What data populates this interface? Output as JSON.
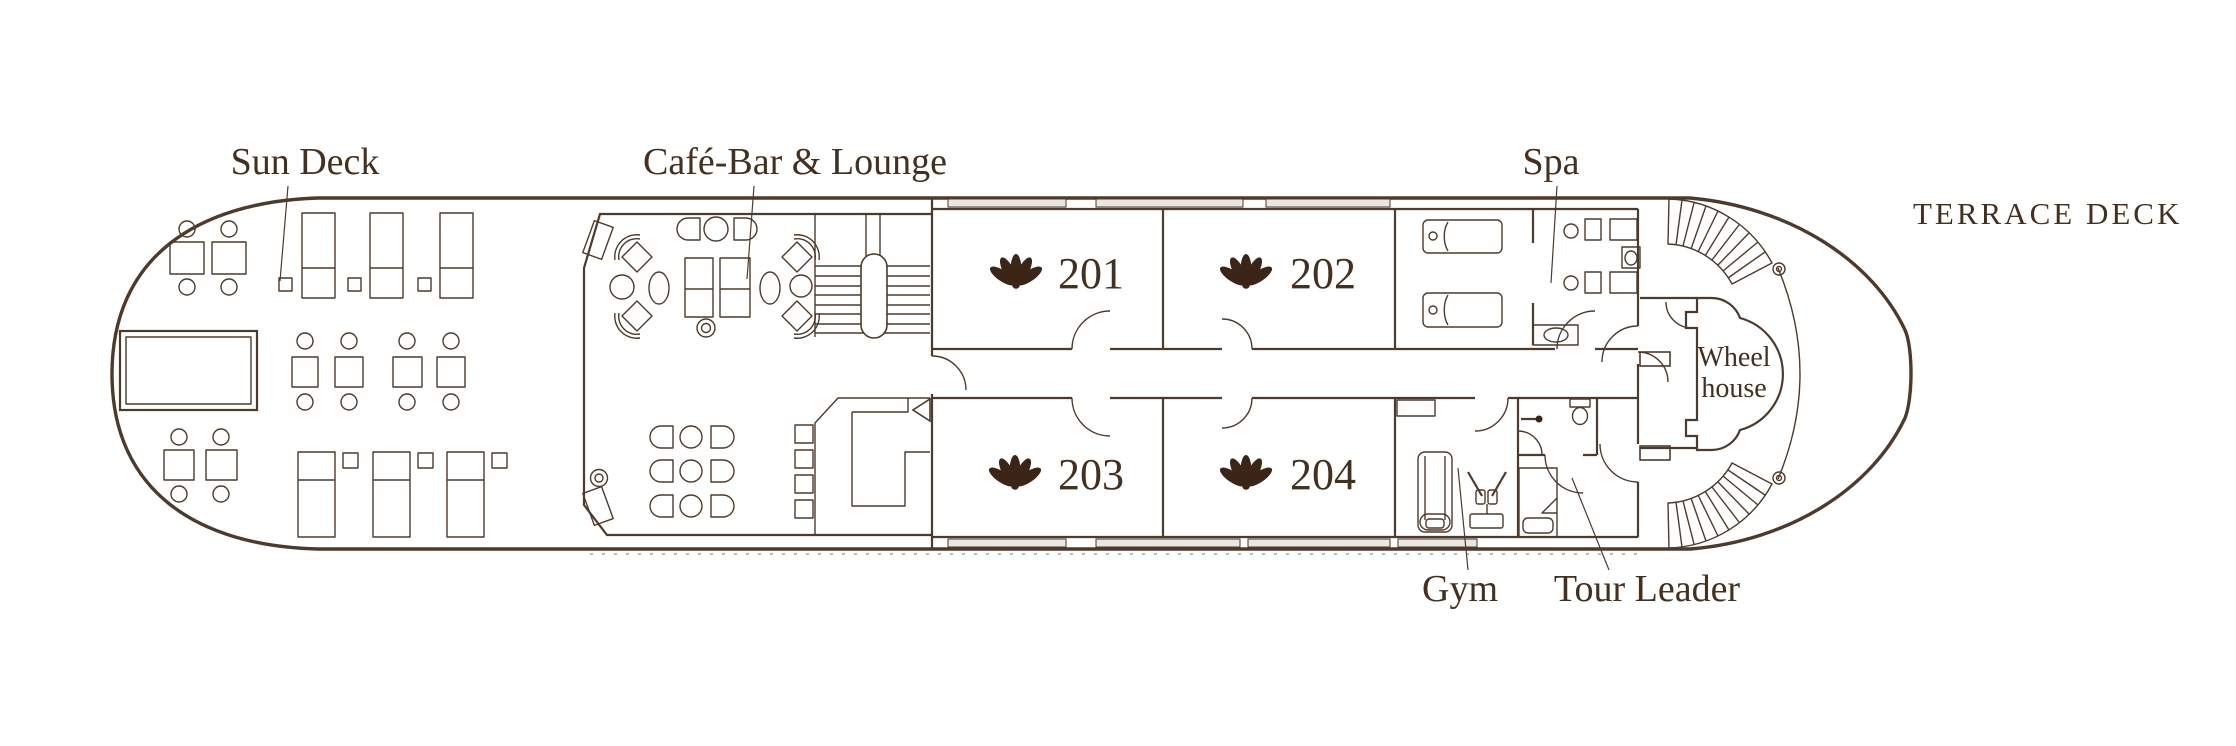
{
  "deck": {
    "title": "TERRACE DECK"
  },
  "areas": {
    "sun_deck": {
      "label": "Sun Deck"
    },
    "cafe_bar_lounge": {
      "label": "Café-Bar & Lounge"
    },
    "spa": {
      "label": "Spa"
    },
    "gym": {
      "label": "Gym"
    },
    "tour_leader": {
      "label": "Tour Leader"
    },
    "wheel_house": {
      "label_line1": "Wheel",
      "label_line2": "house"
    }
  },
  "cabins": [
    {
      "number": "201"
    },
    {
      "number": "202"
    },
    {
      "number": "203"
    },
    {
      "number": "204"
    }
  ],
  "icons": {
    "cabin_marker": "scallop-shell"
  },
  "colors": {
    "line": "#4e3a2b",
    "text": "#44301f",
    "icon": "#3a2517",
    "window": "#eae7e2",
    "background": "#ffffff"
  }
}
